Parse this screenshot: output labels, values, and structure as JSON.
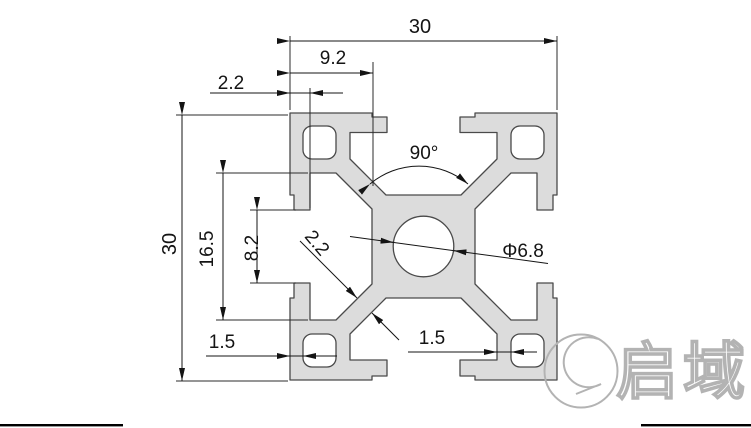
{
  "drawing": {
    "kind": "aluminium-extrusion-profile-cross-section",
    "profile_fill": "#dcdcdc",
    "outline_color": "#4a4a4a",
    "dimension_color": "#141414"
  },
  "dimensions": {
    "overall_width": "30",
    "slot_edge_offset": "9.2",
    "lip_wall_thickness": "2.2",
    "slot_angle": "90°",
    "overall_height": "30",
    "cavity_width": "16.5",
    "slot_opening": "8.2",
    "web_thickness": "2.2",
    "center_hole_dia": "Φ6.8",
    "corner_wall_left": "1.5",
    "corner_wall_bottom": "1.5"
  },
  "watermark": {
    "brand_text": "启域",
    "logo_color": "#b3b3b3"
  }
}
